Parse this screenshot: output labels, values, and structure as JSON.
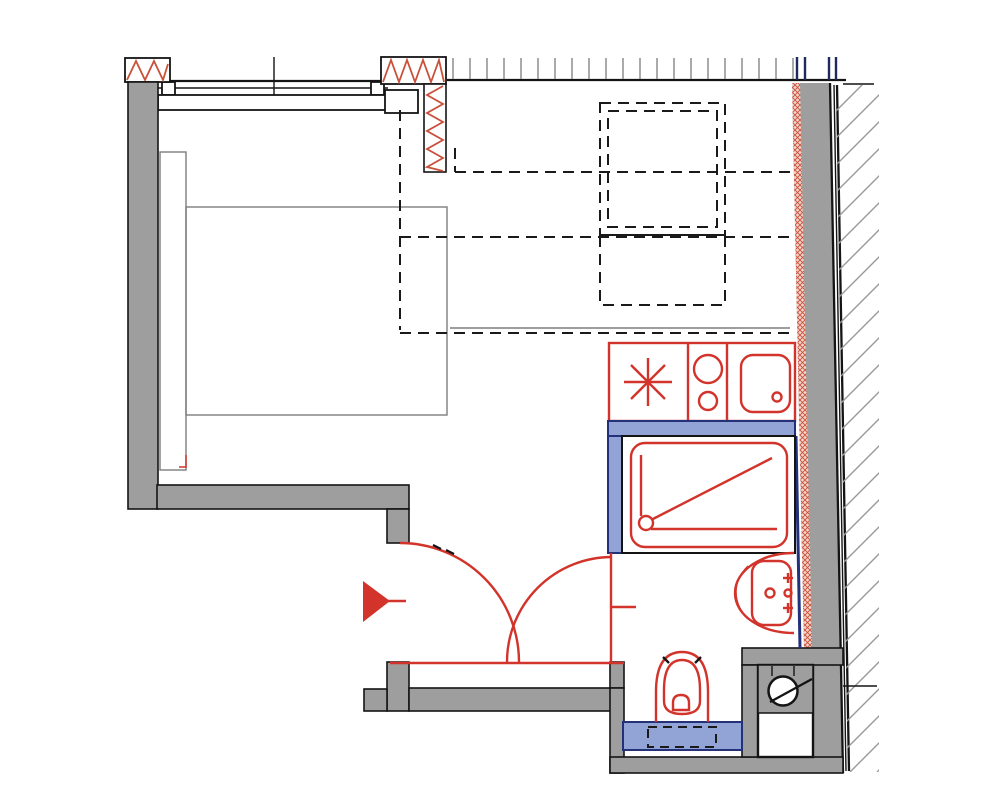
{
  "title": "Studio apartment floor plan drawing",
  "colors": {
    "bg": "#ffffff",
    "wall_fill": "#9e9e9e",
    "outline": "#141414",
    "fixture_red": "#d2342b",
    "insulation_red": "#c9503a",
    "insulation_bg": "#f2d4ca",
    "blue_wall": "#92a3d5",
    "blue_outline": "#23307a",
    "furniture_grey": "#7d7d7d",
    "hatch_grey": "#9a9a9a"
  },
  "elements": {
    "rooms": [
      "living-area",
      "entry-hall",
      "bathroom"
    ],
    "fixtures": [
      "window",
      "bed",
      "headboard-cabinet",
      "overhead-storage-dashed",
      "kitchenette-counter",
      "fridge-asterisk",
      "cooktop-burners",
      "kitchen-sink",
      "shower-tray",
      "washbasin",
      "toilet",
      "washing-machine",
      "entrance-arrow",
      "door-swing-left",
      "door-swing-right",
      "insulated-wall",
      "new-partition-blue",
      "existing-wall-hatch"
    ]
  }
}
